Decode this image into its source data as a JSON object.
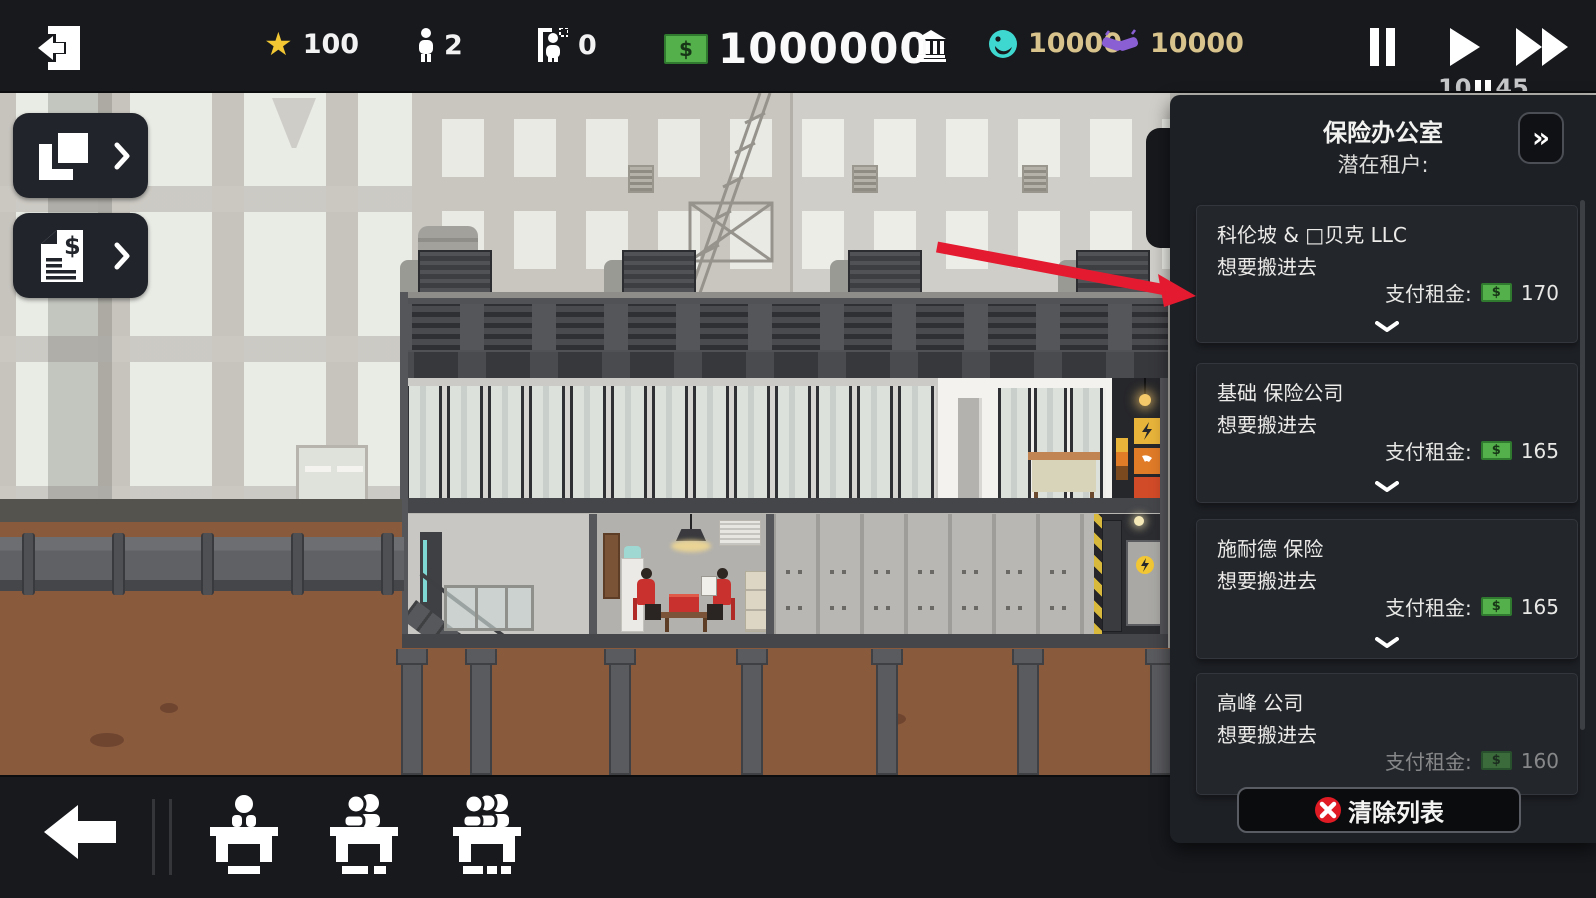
{
  "topbar": {
    "star": "100",
    "population": "2",
    "movers": "0",
    "money": "1000000",
    "influence": "10000",
    "contacts": "10000",
    "clock_left": "10",
    "clock_right": "45"
  },
  "icons": {
    "star_glyph": "★",
    "currency": "$",
    "collapse_glyph": "»"
  },
  "panel": {
    "title": "保险办公室",
    "subtitle": "潜在租户:",
    "rent_label": "支付租金:",
    "tenants": [
      {
        "name": "科伦坡 & □贝克 LLC",
        "status": "想要搬进去",
        "rent": "170"
      },
      {
        "name": "基础 保险公司",
        "status": "想要搬进去",
        "rent": "165"
      },
      {
        "name": "施耐德 保险",
        "status": "想要搬进去",
        "rent": "165"
      },
      {
        "name": "高峰 公司",
        "status": "想要搬进去",
        "rent": "160"
      }
    ],
    "clear_button_label": "清除列表"
  },
  "colors": {
    "money_green": "#54b04a",
    "star_gold": "#f2c733",
    "resource_tan": "#d9c38c",
    "influence_cyan": "#3fd8d0",
    "contacts_purple": "#8a5fd4",
    "arrow_red": "#e41b30",
    "panel_bg": "#1d2025",
    "bar_bg": "#17191d"
  }
}
